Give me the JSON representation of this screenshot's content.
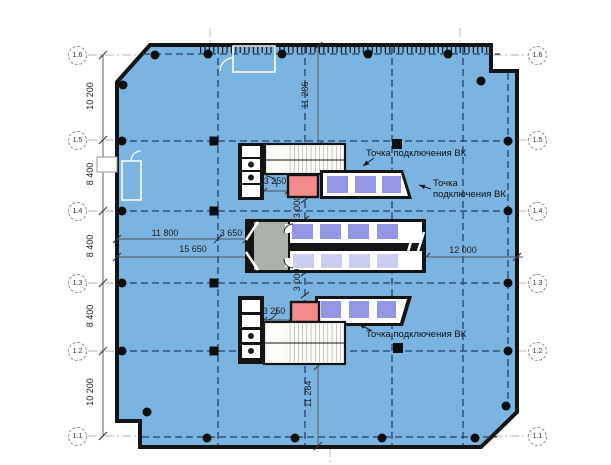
{
  "axes": {
    "left": [
      "1.6",
      "1.5",
      "1.4",
      "1.3",
      "1.2",
      "1.1"
    ],
    "right": [
      "1.6",
      "1.5",
      "1.4",
      "1.3",
      "1.2",
      "1.1"
    ]
  },
  "dims": {
    "left": [
      "10 200",
      "8 400",
      "8 400",
      "8 400",
      "10 200"
    ],
    "top_span": "11 286",
    "bottom_span": "11 284",
    "gap_top": "3 000",
    "gap_bottom": "3 000",
    "core_top": "3 250",
    "core_bottom": "3 250",
    "row_a": "11 800",
    "row_b": "3 650",
    "row_total": "15 650",
    "row_right": "12 000"
  },
  "annotations": {
    "vk_top": "Точка подключения ВК",
    "vk_right_l1": "Точка",
    "vk_right_l2": "подключения ВК",
    "vk_bottom": "Точка подключения ВК"
  },
  "colors": {
    "floor": "#7CB4E1",
    "wall": "#141414",
    "axis": "#20416B",
    "cellDark": "#9396E5",
    "cellLight": "#CBCDF2",
    "red": "#F28C8C",
    "gray": "#AAB2AA"
  }
}
